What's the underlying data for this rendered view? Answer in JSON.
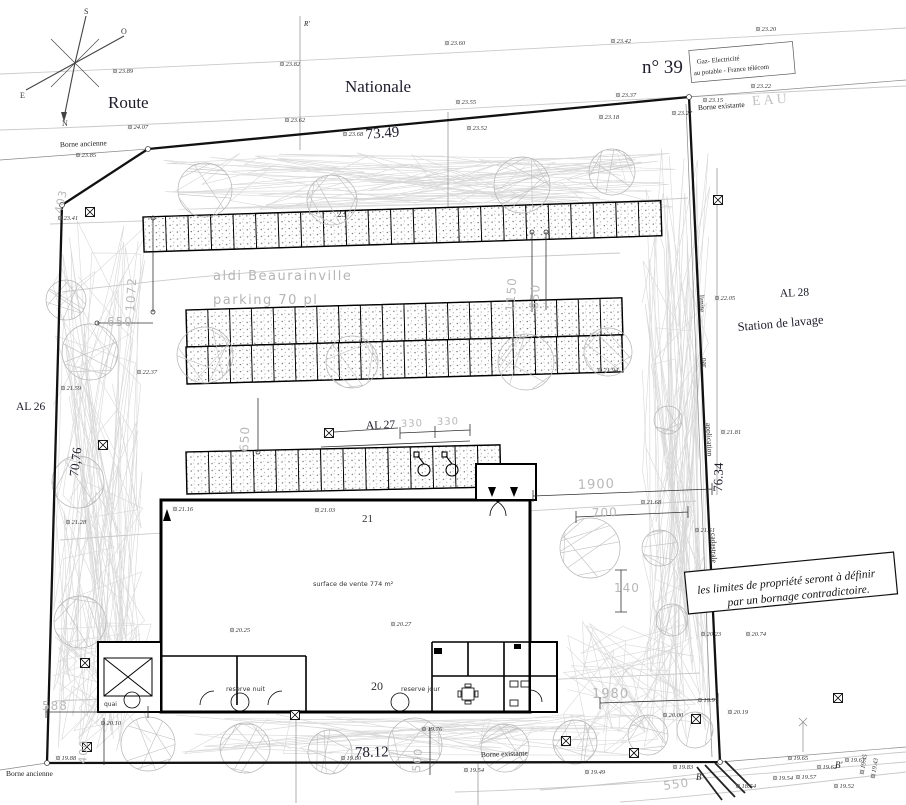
{
  "site_plan": {
    "compass": {
      "n": "N",
      "s": "S",
      "e": "E",
      "o": "O"
    },
    "road": {
      "route": "Route",
      "nationale": "Nationale"
    },
    "parcels": {
      "n39": "n° 39",
      "al26": "AL 26",
      "al27": "AL 27",
      "al28": "AL 28",
      "station_lavage": "Station de lavage"
    },
    "utilities_box": {
      "line1": "Gaz- Electricité",
      "line2": "au potable - France télécom",
      "eau": "EAU"
    },
    "markers": {
      "borne_existante_top": "Borne existante",
      "borne_ancienne_top": "Borne ancienne",
      "borne_existante_bottom": "Borne existante",
      "borne_ancienne_bottom": "Borne ancienne",
      "r_prime": "R'",
      "b": "B",
      "b_prime": "B'"
    },
    "cadastral_note": [
      "limite",
      "par",
      "application",
      "cadastrale"
    ],
    "note_box": {
      "line1": "les limites de propriété seront à définir",
      "line2": "par un bornage contradictoire."
    },
    "project": {
      "name_line1": "aldi Beaurainville",
      "name_line2": "parking 70 pl",
      "sales_area": "surface de vente 774 m²",
      "reserve_nuit": "reserve nuit",
      "reserve_jour": "reserve jour",
      "quai": "quai"
    },
    "boundary_dims": {
      "top": "73.49",
      "bottom": "78.12",
      "right": "76.34",
      "left": "70,76"
    },
    "contour_labels": [
      {
        "v": "23",
        "x": 337,
        "y": 217,
        "cls": "contour-lb-s"
      },
      {
        "v": "21",
        "x": 362,
        "y": 522,
        "cls": "contour-lb"
      },
      {
        "v": "20",
        "x": 371,
        "y": 690,
        "cls": "contour-lb-l"
      }
    ],
    "gray_dims": [
      {
        "v": "403",
        "x": 62,
        "y": 214,
        "r": -78,
        "s": 11
      },
      {
        "v": "1072",
        "x": 134,
        "y": 312,
        "r": -86,
        "s": 12
      },
      {
        "v": "650",
        "x": 107,
        "y": 326,
        "r": 0,
        "s": 12
      },
      {
        "v": "650",
        "x": 248,
        "y": 452,
        "r": -87,
        "s": 12
      },
      {
        "v": "1150",
        "x": 514,
        "y": 312,
        "r": -86,
        "s": 12
      },
      {
        "v": "650",
        "x": 538,
        "y": 310,
        "r": -86,
        "s": 12
      },
      {
        "v": "330",
        "x": 401,
        "y": 427,
        "r": -2,
        "s": 10
      },
      {
        "v": "330",
        "x": 437,
        "y": 425,
        "r": -2,
        "s": 10
      },
      {
        "v": "1900",
        "x": 578,
        "y": 489,
        "r": -2,
        "s": 13
      },
      {
        "v": "700",
        "x": 592,
        "y": 517,
        "r": -2,
        "s": 12
      },
      {
        "v": "140",
        "x": 614,
        "y": 592,
        "r": 0,
        "s": 12
      },
      {
        "v": "1980",
        "x": 592,
        "y": 698,
        "r": 0,
        "s": 13
      },
      {
        "v": "550",
        "x": 664,
        "y": 790,
        "r": -8,
        "s": 12
      },
      {
        "v": "588",
        "x": 42,
        "y": 710,
        "r": 0,
        "s": 12
      },
      {
        "v": "400",
        "x": 86,
        "y": 764,
        "r": -85,
        "s": 11
      },
      {
        "v": "500",
        "x": 420,
        "y": 772,
        "r": -85,
        "s": 11
      }
    ],
    "elevations": [
      [
        115,
        71,
        "23.89"
      ],
      [
        282,
        64,
        "23.82"
      ],
      [
        130,
        127,
        "24.07"
      ],
      [
        78,
        155,
        "23.85"
      ],
      [
        447,
        43,
        "23.60"
      ],
      [
        287,
        120,
        "23.62"
      ],
      [
        345,
        134,
        "23.68"
      ],
      [
        458,
        102,
        "23.55"
      ],
      [
        469,
        128,
        "23.52"
      ],
      [
        613,
        41,
        "23.42"
      ],
      [
        758,
        29,
        "23.20"
      ],
      [
        618,
        95,
        "23.37"
      ],
      [
        753,
        86,
        "23.22"
      ],
      [
        705,
        100,
        "23.15"
      ],
      [
        674,
        113,
        "23.27"
      ],
      [
        601,
        117,
        "23.18"
      ],
      [
        60,
        218,
        "23.41"
      ],
      [
        63,
        388,
        "21.59"
      ],
      [
        68,
        522,
        "21.28"
      ],
      [
        139,
        372,
        "22.37"
      ],
      [
        600,
        370,
        "21.94"
      ],
      [
        717,
        298,
        "22.05"
      ],
      [
        723,
        432,
        "21.81"
      ],
      [
        643,
        502,
        "21.68"
      ],
      [
        175,
        509,
        "21.16"
      ],
      [
        317,
        510,
        "21.03"
      ],
      [
        697,
        530,
        "21.51"
      ],
      [
        232,
        630,
        "20.25"
      ],
      [
        393,
        624,
        "20.27"
      ],
      [
        748,
        634,
        "20.74"
      ],
      [
        703,
        634,
        "20.23"
      ],
      [
        424,
        729,
        "19.76"
      ],
      [
        343,
        758,
        "19.80"
      ],
      [
        466,
        770,
        "19.54"
      ],
      [
        587,
        772,
        "19.49"
      ],
      [
        665,
        715,
        "20.00"
      ],
      [
        730,
        712,
        "20.19"
      ],
      [
        700,
        700,
        "19.91"
      ],
      [
        675,
        767,
        "19.83"
      ],
      [
        790,
        758,
        "19.65"
      ],
      [
        819,
        767,
        "19.62"
      ],
      [
        847,
        760,
        "19.61"
      ],
      [
        798,
        777,
        "19.57"
      ],
      [
        775,
        778,
        "19.54"
      ],
      [
        836,
        786,
        "19.52"
      ],
      [
        738,
        786,
        "18.54"
      ],
      [
        103,
        723,
        "20.10"
      ],
      [
        58,
        758,
        "19.88"
      ],
      [
        862,
        772,
        "19.45",
        -80
      ],
      [
        873,
        776,
        "19.43",
        -80
      ]
    ]
  }
}
